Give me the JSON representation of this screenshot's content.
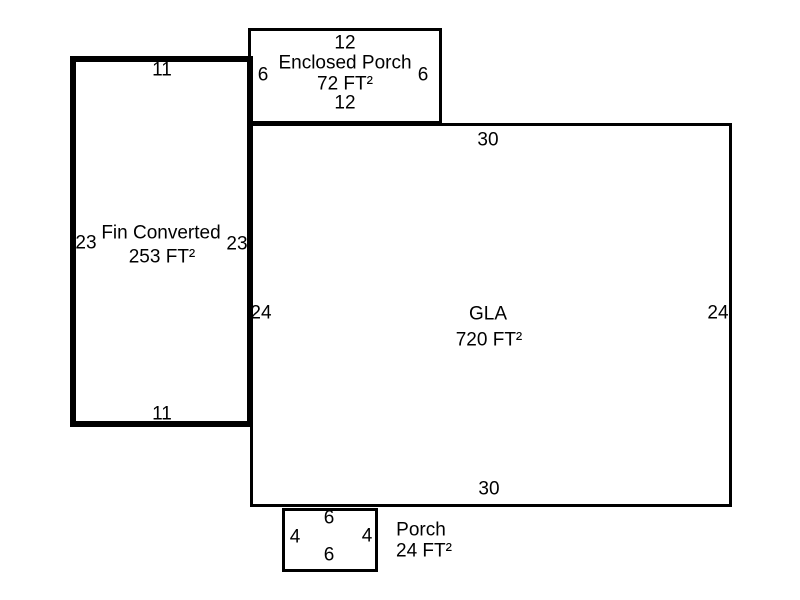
{
  "diagram": {
    "type": "floor-plan-sketch",
    "units": "FT",
    "colors": {
      "line": "#000000",
      "background": "#ffffff",
      "text": "#000000"
    },
    "areas": {
      "enclosed_porch": {
        "name": "Enclosed Porch",
        "area": "72 FT²",
        "dims": {
          "top": "12",
          "bottom": "12",
          "left": "6",
          "right": "6"
        }
      },
      "fin_converted": {
        "name": "Fin Converted",
        "area": "253 FT²",
        "dims": {
          "top": "11",
          "bottom": "11",
          "left": "23",
          "right": "23"
        }
      },
      "gla": {
        "name": "GLA",
        "area": "720 FT²",
        "dims": {
          "top": "30",
          "bottom": "30",
          "left": "24",
          "right": "24"
        }
      },
      "porch": {
        "name": "Porch",
        "area": "24 FT²",
        "dims": {
          "top": "6",
          "bottom": "6",
          "left": "4",
          "right": "4"
        }
      }
    }
  }
}
